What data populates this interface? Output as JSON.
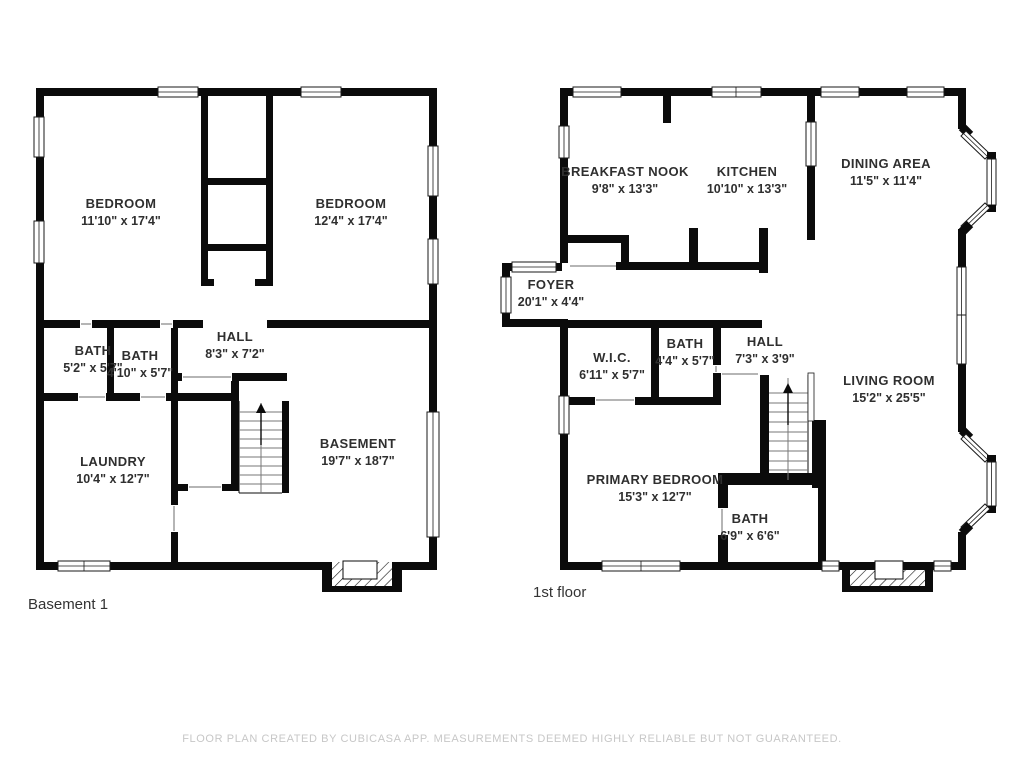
{
  "colors": {
    "wall": "#0b0b0b",
    "room_label": "#2f2f2f",
    "floor_title": "#333333",
    "footer_text": "#c7c7c7"
  },
  "footer": {
    "text": "FLOOR PLAN CREATED BY CUBICASA APP. MEASUREMENTS DEEMED HIGHLY RELIABLE BUT NOT GUARANTEED."
  },
  "floors": [
    {
      "title": "Basement 1",
      "rooms": [
        {
          "name": "BEDROOM",
          "dims": "11'10\" x 17'4\""
        },
        {
          "name": "BEDROOM",
          "dims": "12'4\" x 17'4\""
        },
        {
          "name": "HALL",
          "dims": "8'3\" x 7'2\""
        },
        {
          "name": "BATH",
          "dims": "5'2\" x 5'7\""
        },
        {
          "name": "BATH",
          "dims": "4'10\" x 5'7\""
        },
        {
          "name": "LAUNDRY",
          "dims": "10'4\" x 12'7\""
        },
        {
          "name": "BASEMENT",
          "dims": "19'7\" x 18'7\""
        }
      ]
    },
    {
      "title": "1st floor",
      "rooms": [
        {
          "name": "BREAKFAST NOOK",
          "dims": "9'8\" x 13'3\""
        },
        {
          "name": "KITCHEN",
          "dims": "10'10\" x 13'3\""
        },
        {
          "name": "DINING AREA",
          "dims": "11'5\" x 11'4\""
        },
        {
          "name": "FOYER",
          "dims": "20'1\" x 4'4\""
        },
        {
          "name": "W.I.C.",
          "dims": "6'11\" x 5'7\""
        },
        {
          "name": "BATH",
          "dims": "4'4\" x 5'7\""
        },
        {
          "name": "HALL",
          "dims": "7'3\" x 3'9\""
        },
        {
          "name": "LIVING ROOM",
          "dims": "15'2\" x 25'5\""
        },
        {
          "name": "PRIMARY BEDROOM",
          "dims": "15'3\" x 12'7\""
        },
        {
          "name": "BATH",
          "dims": "6'9\" x 6'6\""
        }
      ]
    }
  ]
}
